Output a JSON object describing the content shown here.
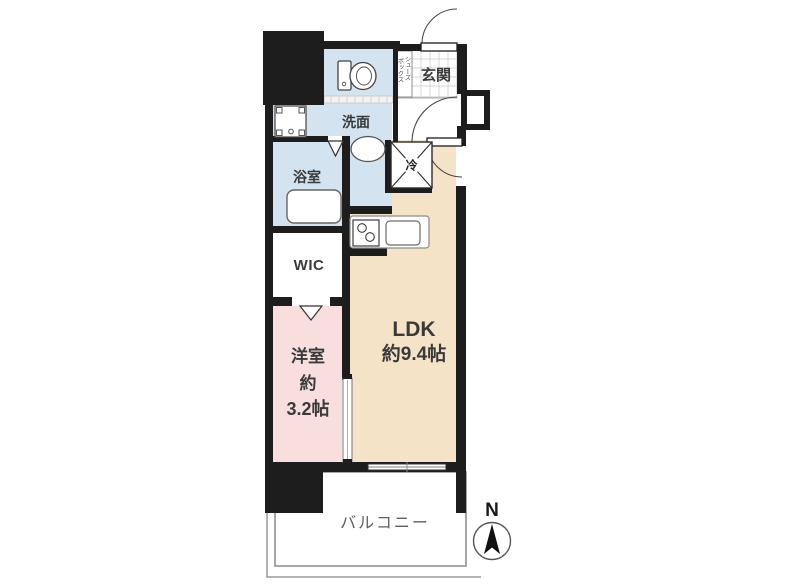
{
  "plan_labels": {
    "genkan": "玄関",
    "shoebox_line1": "シューズ",
    "shoebox_line2": "ボックス",
    "washroom": "洗面",
    "bathroom": "浴室",
    "wic": "WIC",
    "western_room": "洋室",
    "western_room_approx": "約",
    "western_room_size": "3.2帖",
    "ldk": "LDK",
    "ldk_size": "約9.4帖",
    "balcony": "バルコニー",
    "refrigerator": "冷",
    "compass_north": "N"
  },
  "colors": {
    "wall": "#1d1d1d",
    "wet_area_fill": "#d3e3ef",
    "ldk_fill": "#f5e3c8",
    "western_room_fill": "#f8dfdd",
    "balcony_line": "#8a8a8a"
  }
}
